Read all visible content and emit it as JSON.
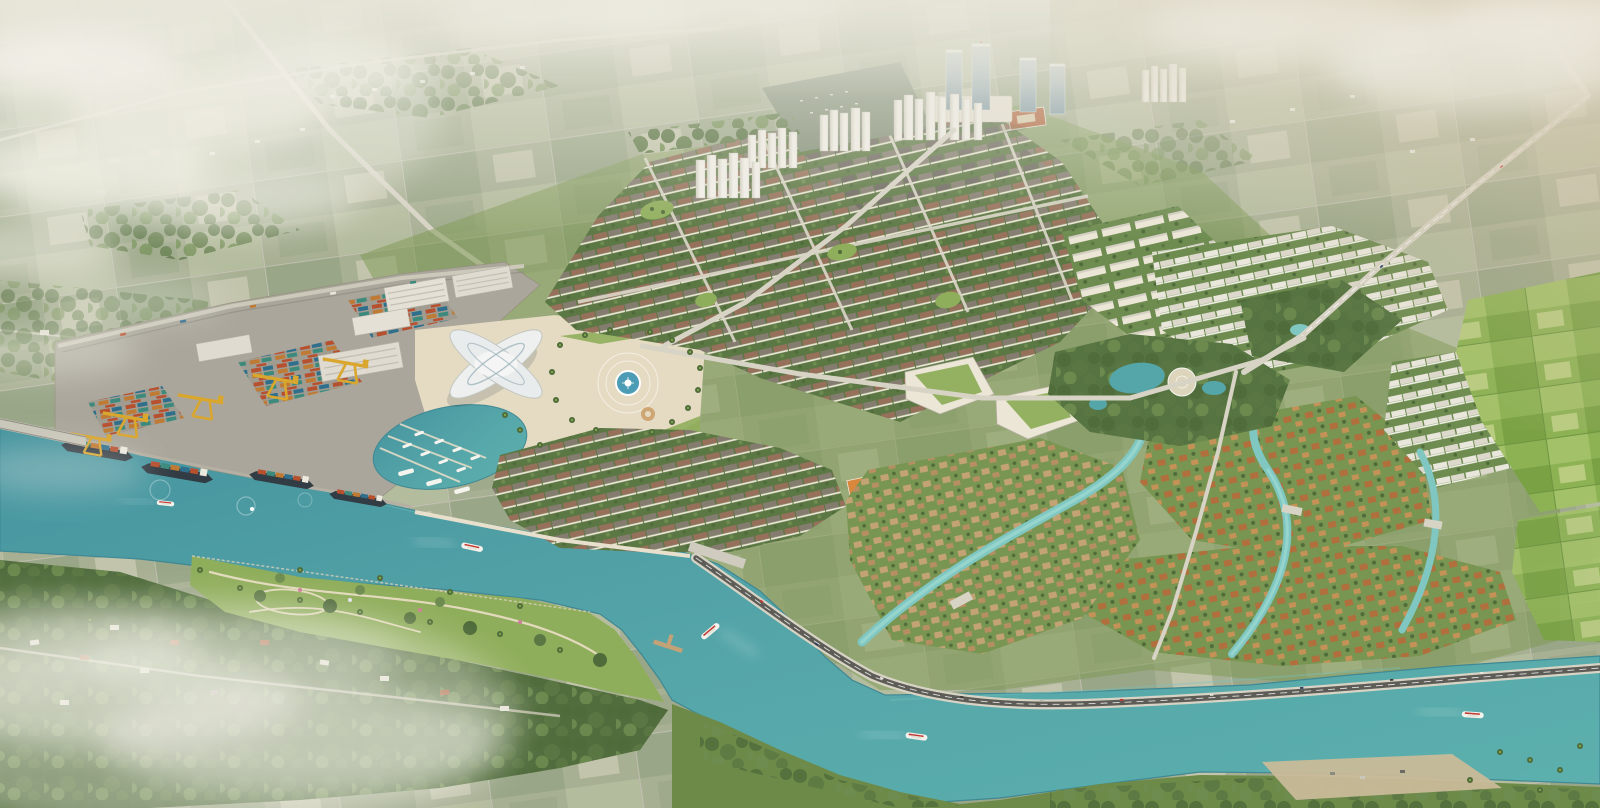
{
  "scene": {
    "title": "Aerial rendering of a riverside township masterplan with container port, marina landmark, townhouse grids, villa districts, canals and a winding teal river",
    "time_of_day": "hazy morning",
    "regions": {
      "far_countryside": "Misty farmland and country roads fading to haze",
      "highrise_cluster": "Glass office towers, podium mall and white apartment towers",
      "townhouse_district": "Dense grid blocks of low-rise townhouses with tree-lined streets",
      "apartment_blocks": "Cream mid-rise apartment slabs",
      "port": "Container terminal with gantry cranes, warehouses, stacked containers and moored ships",
      "landmark": "Winged white exhibition building beside a yacht marina",
      "plaza": "Circular paved plaza with central fountain and palm trees",
      "shophouse_waterfront": "Rows of shophouses along the river promenade",
      "office_green_roofs": "Low office and school buildings with planted green roofs",
      "lake_park": "Landscaped park with lake, ponds and round white plaza",
      "villa_district_east": "Orange and tan roofed villa neighborhoods threaded by canals",
      "white_row_housing": "White rowhouse grids at the north east",
      "farmland_east": "Bright green paddy fields",
      "riverside_park": "South bank lawn park with curved walking paths",
      "old_village": "Existing village under trees along the bottom left",
      "river": "Wide teal river bending around the development",
      "atmosphere": "White clouds top left, sepia haze right, ground fog bottom left"
    },
    "objects": {
      "glass_towers": 4,
      "white_apartment_towers": 28,
      "gantry_cranes": 5,
      "container_ships": 4,
      "warehouses": 5,
      "cruise_boats": 4,
      "speedboats": 2,
      "marina_yachts": 11,
      "fountains": 1,
      "road_bridges": 2,
      "canal_bridges": 3
    }
  },
  "colors": {
    "haze": "#e9e7db",
    "sepia": "#cdbc9c",
    "far": "#a8b094",
    "field1": "#b4bc9e",
    "field2": "#99a687",
    "field3": "#c2c4ac",
    "farm1": "#8db254",
    "farm2": "#7aa244",
    "farm3": "#a3c168",
    "forest": "#4f6b3a",
    "tree1": "#5b7743",
    "tree2": "#6e8c50",
    "grass": "#8fae5b",
    "grassd": "#789551",
    "river": "#55a6a9",
    "riverd": "#46949f",
    "canal": "#7fc7c0",
    "pool": "#4d9cb5",
    "road": "#d7d3c5",
    "asphalt": "#5d5c56",
    "pave": "#e5dbc2",
    "plaza": "#dbcdb1",
    "wallc": "#ece6d6",
    "white": "#f1efe8",
    "shade": "#d3cfc3",
    "roofg": "#857c70",
    "roofd": "#6b665e",
    "roofb": "#96705a",
    "villao": "#b06f3d",
    "villat": "#c49257",
    "housetan": "#c3a374",
    "glass1": "#b9c9cd",
    "glass2": "#7e97a3",
    "yellow": "#d9a62e",
    "cred": "#b7502f",
    "cblue": "#2f6f8c",
    "cteal": "#3c8a7c",
    "corange": "#bf7a33",
    "hull": "#323c44",
    "sand": "#c9ba99",
    "fog": "#f2f0e7"
  }
}
